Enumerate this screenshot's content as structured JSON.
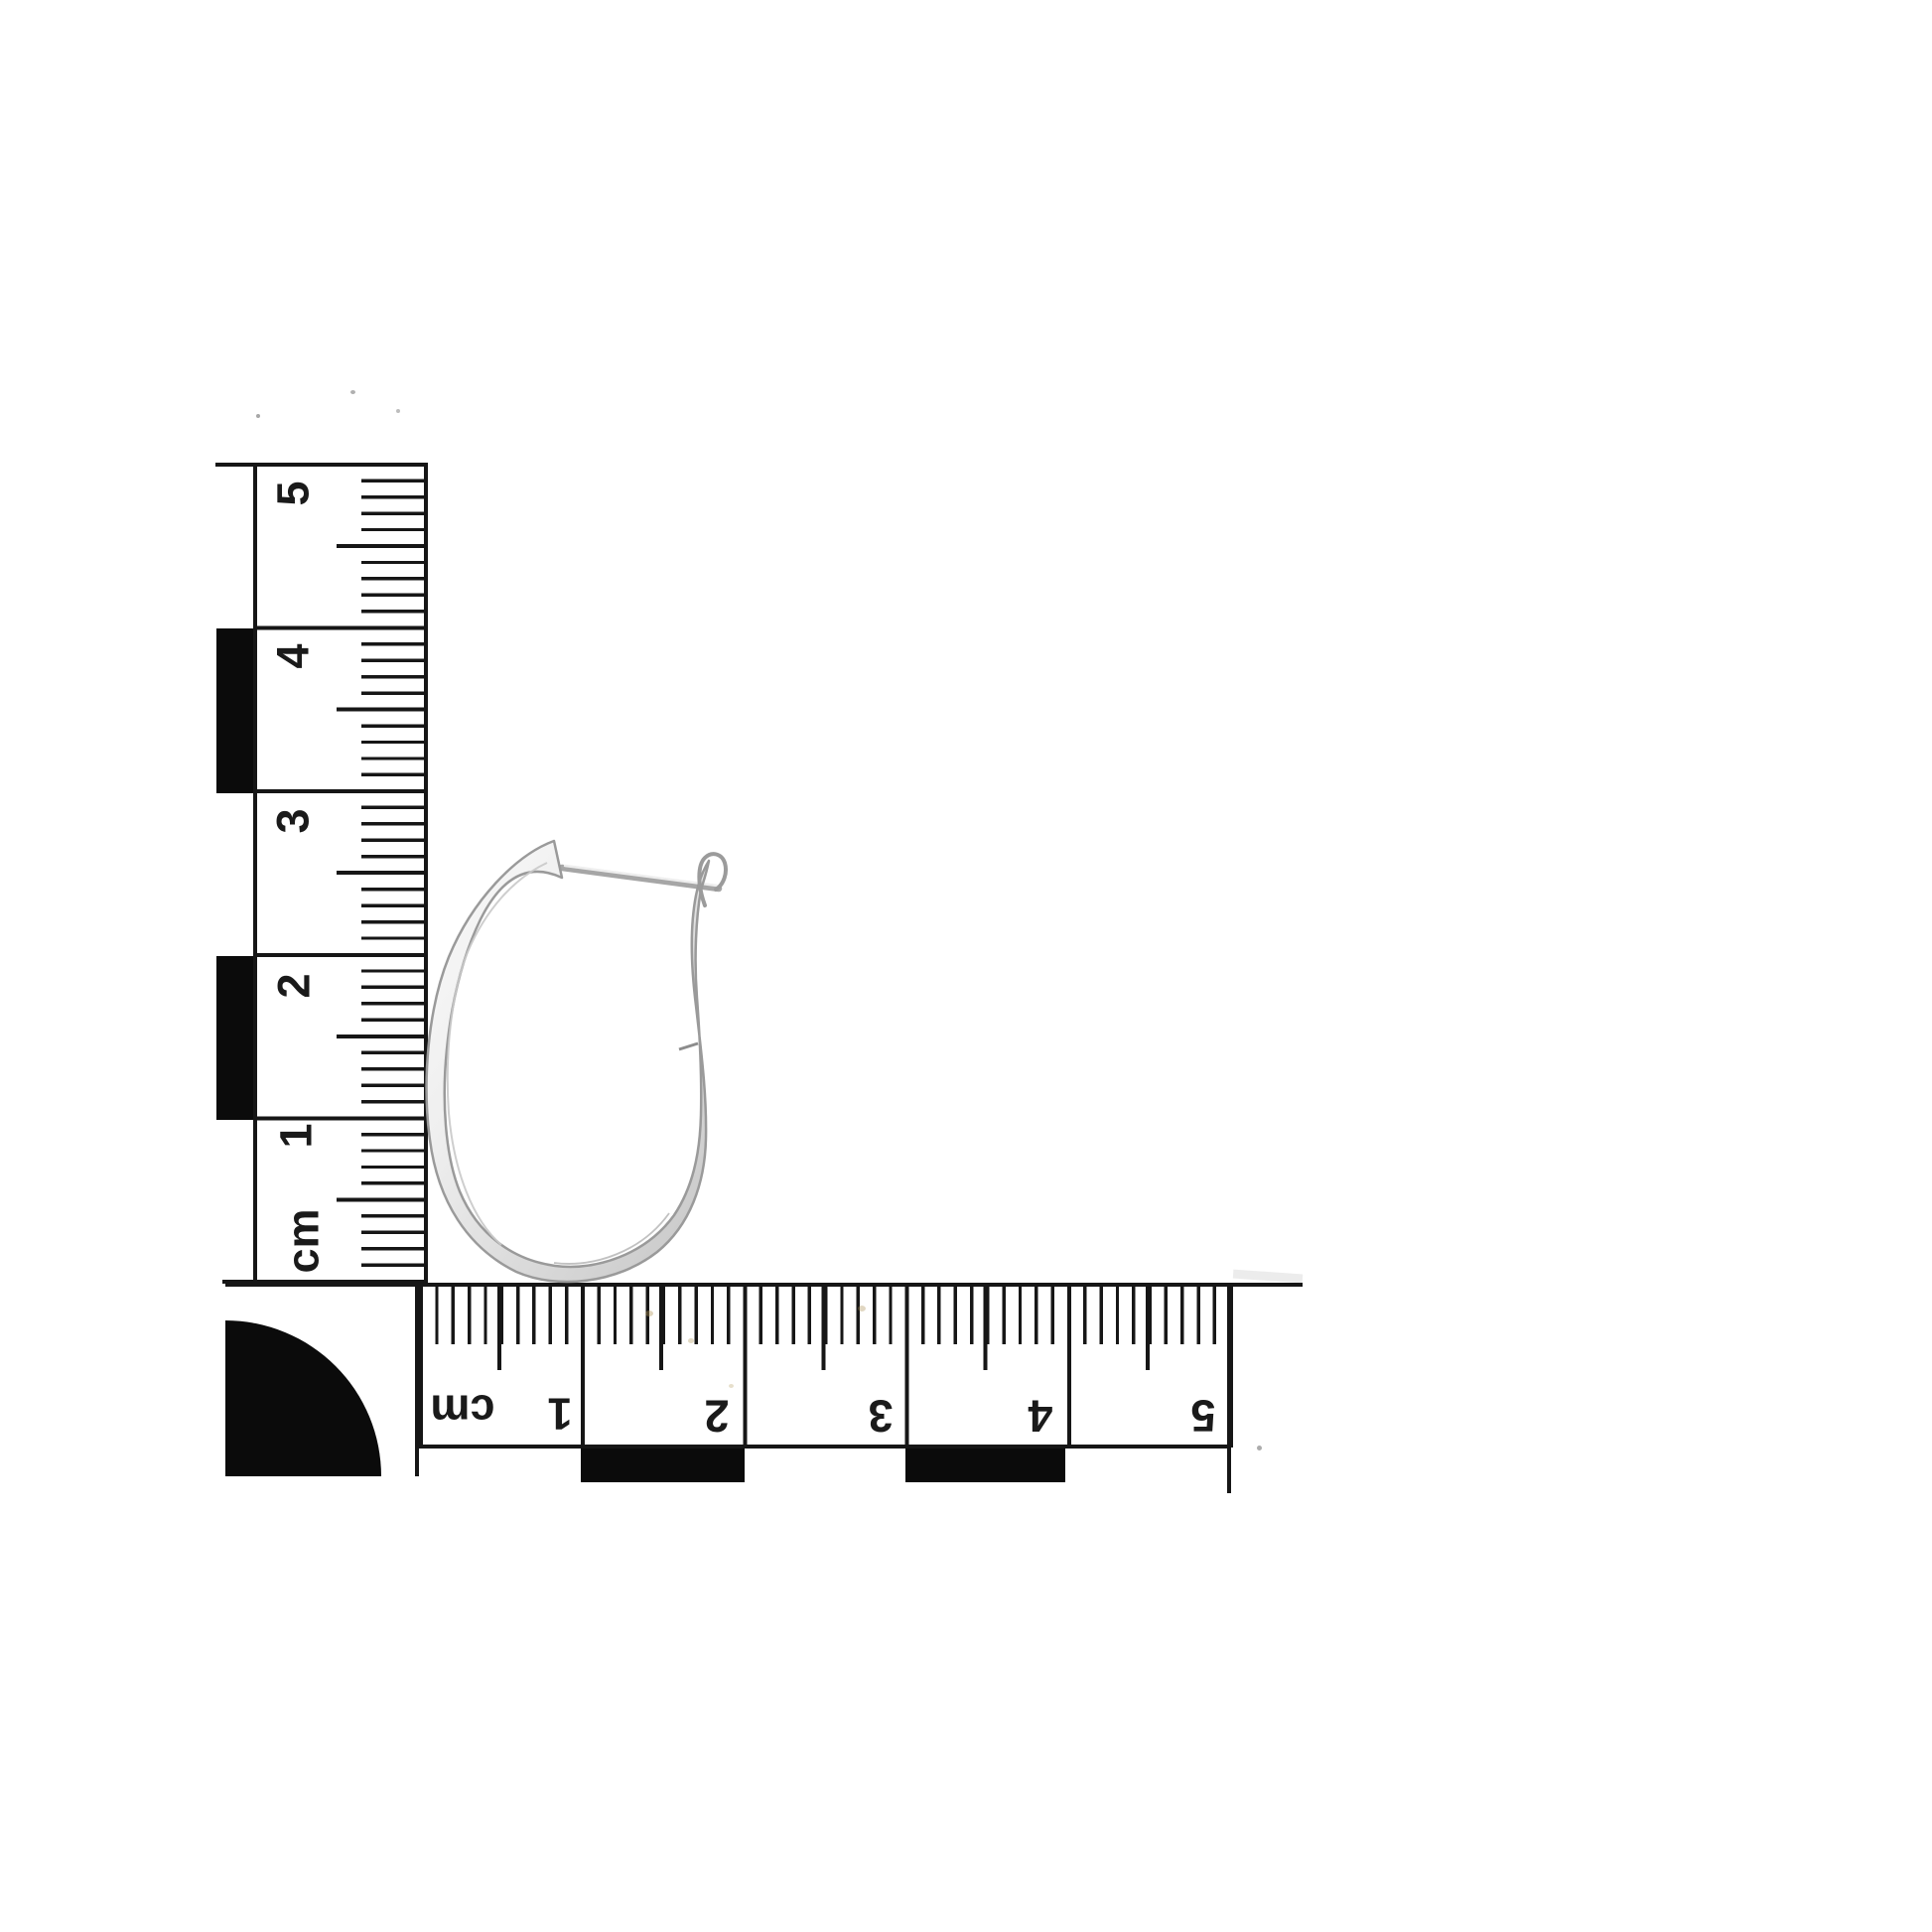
{
  "photo": {
    "subject": "White gold oval hoop earring photographed on white with a centimetre scale card",
    "background_color": "#ffffff"
  },
  "scale_card": {
    "unit": "cm",
    "print_color": "#161616",
    "block_color": "#0b0b0b",
    "vertical_ruler": {
      "unit_label": "cm",
      "labels": [
        "5",
        "4",
        "3",
        "2",
        "1"
      ],
      "ticks_per_cm": 10
    },
    "horizontal_ruler": {
      "unit_label": "cm",
      "labels": [
        "1",
        "2",
        "3",
        "4",
        "5"
      ],
      "ticks_per_cm": 10
    }
  },
  "earring": {
    "name": "oval hoop earring with latch-back wire and hinge",
    "metal_color_light": "#f7f7f7",
    "metal_color_mid": "#dcdcdc",
    "metal_color_edge": "#9a9a9a",
    "approx_height_cm": 2.8,
    "approx_width_cm": 1.8
  }
}
